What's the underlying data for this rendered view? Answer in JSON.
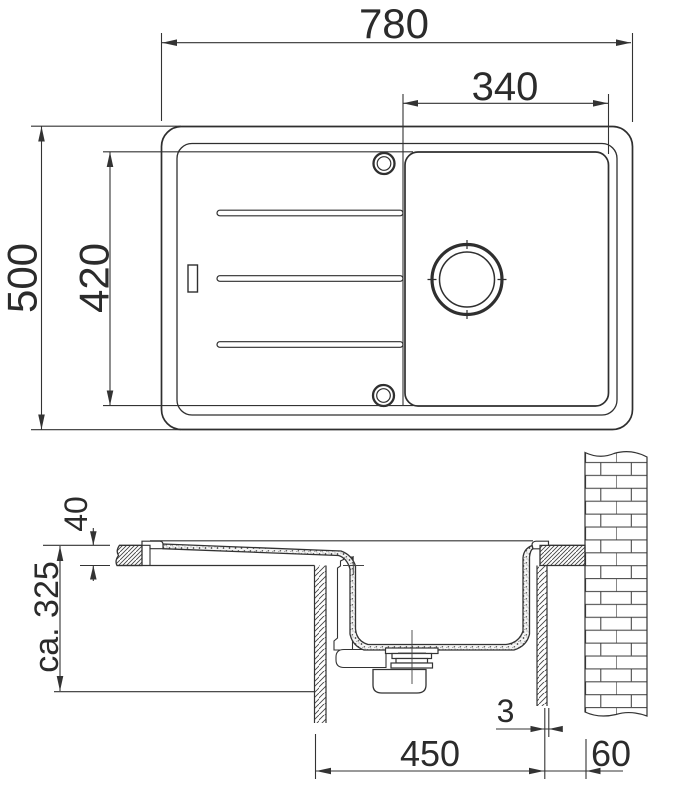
{
  "drawing": {
    "type": "technical-drawing-sink",
    "plan": {
      "width_mm": "780",
      "bowl_width_mm": "340",
      "height_mm": "500",
      "inner_height_mm": "420"
    },
    "section": {
      "counter_thickness_mm": "40",
      "install_depth_mm": "ca. 325",
      "cabinet_width_mm": "450",
      "gap_mm": "3",
      "wall_offset_mm": "60"
    },
    "colors": {
      "line": "#333333",
      "text": "#2b2b2b",
      "background": "#ffffff"
    }
  }
}
